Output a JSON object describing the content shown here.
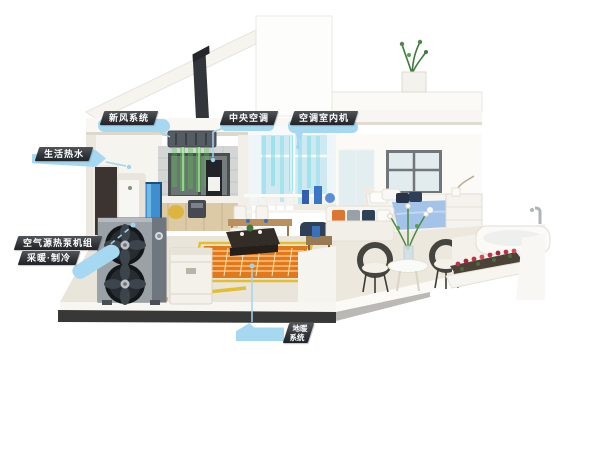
{
  "callouts": {
    "fresh_air": {
      "label": "新风系统"
    },
    "central_ac": {
      "label": "中央空调"
    },
    "ac_indoor_unit": {
      "label": "空调室内机"
    },
    "hot_water": {
      "label": "生活热水"
    },
    "heat_pump": {
      "line1": "空气源热泵机组",
      "line2": "采暖·制冷"
    },
    "floor_heating": {
      "line1": "地暖",
      "line2": "系统"
    }
  },
  "colors": {
    "page_bg": "#ffffff",
    "callout_bubble": "#a6d8f1",
    "callout_ribbon": "#33373b",
    "callout_text": "#ffffff",
    "leader_line": "#9fd6ee",
    "pipe_yellow": "#e3bf2e",
    "mat_orange": "#e0791c",
    "coil_light": "#f5b066",
    "airflow_green": "#52c44a",
    "airflow_cyan": "#7fdde8",
    "heatpump_body": "#9aa2a8",
    "heatpump_dark": "#14171a",
    "blanket_blue": "#a3c3e8",
    "flower_red": "#c23045",
    "ground_shadow": "#383837"
  }
}
